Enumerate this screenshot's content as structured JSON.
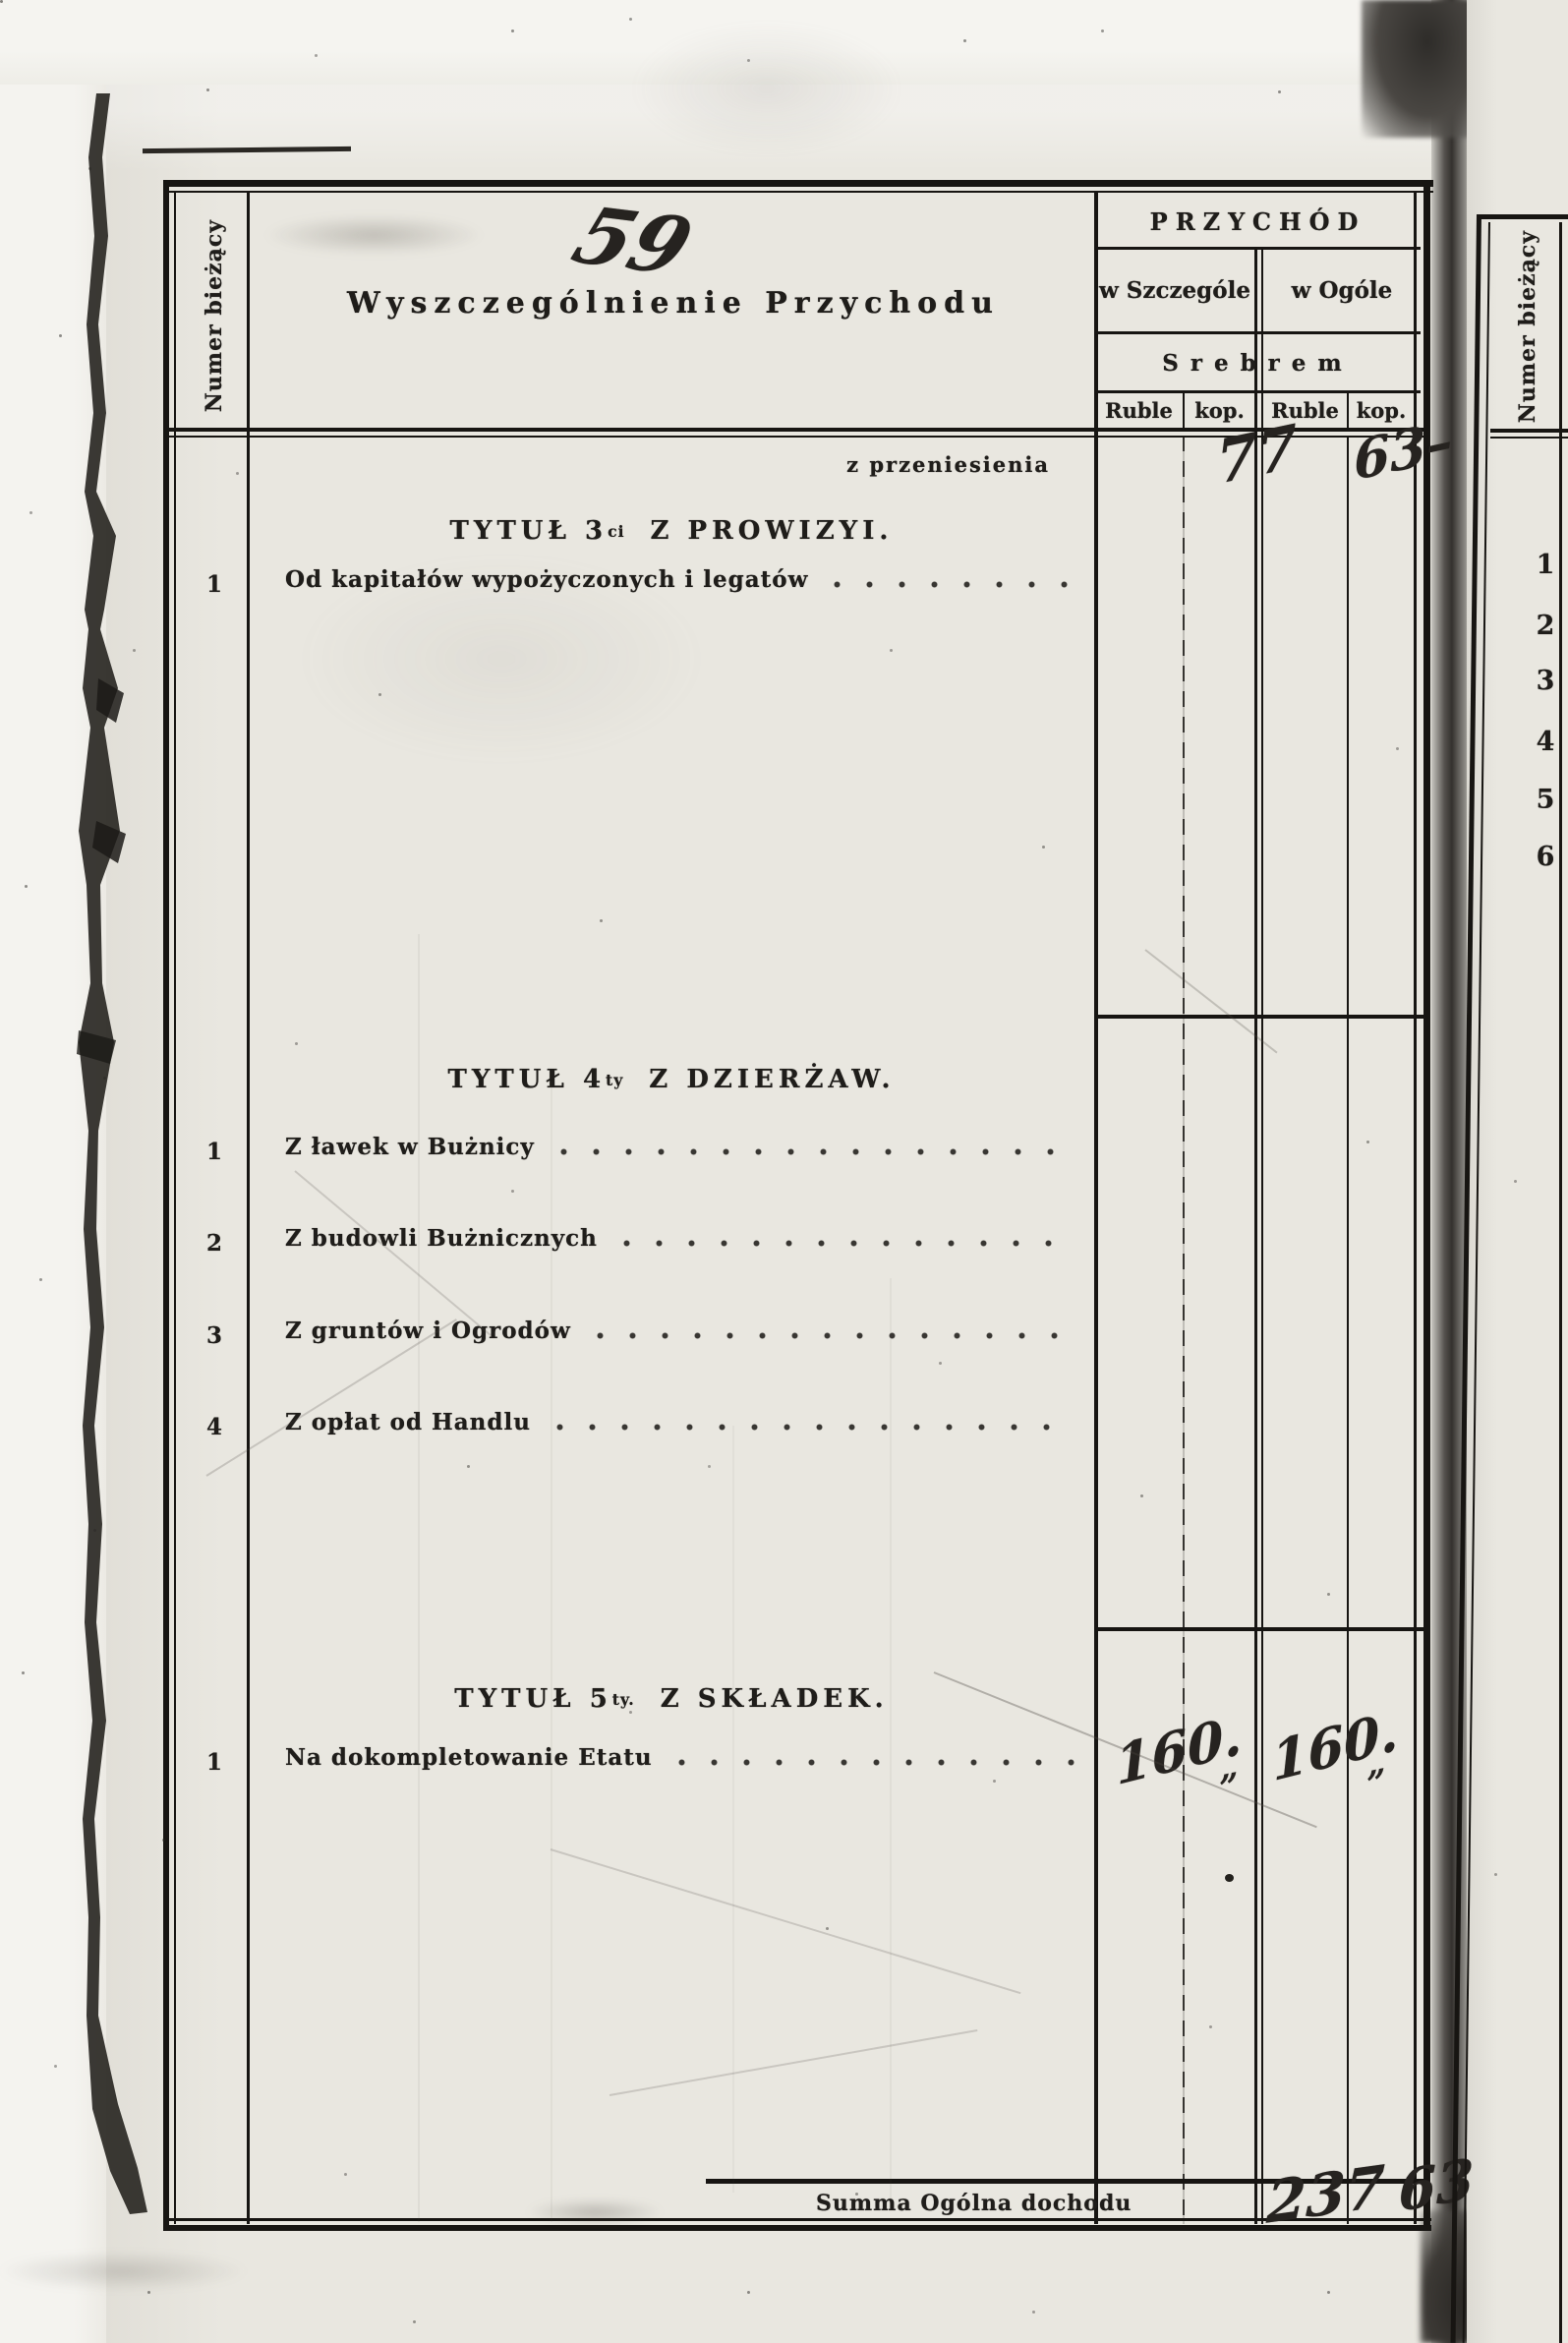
{
  "colors": {
    "paper": "#e9e7e0",
    "ink": "#1f1d1a",
    "gutter_shadow": "#34312e"
  },
  "page_marks": {
    "handwritten_page_number": "59"
  },
  "left_column": {
    "label": "Numer bieżący"
  },
  "header": {
    "description_title": "Wyszczególnienie  Przychodu",
    "income_title": "PRZYCHÓD",
    "col_detail": "w Szczególe",
    "col_total": "w Ogóle",
    "currency_row": "Srebrem",
    "subcols": {
      "c1": "Ruble",
      "c2": "kop.",
      "c3": "Ruble",
      "c4": "kop."
    }
  },
  "carryover": {
    "label": "z przeniesienia",
    "ogole_ruble": "77",
    "ogole_kop": "63–"
  },
  "sections": [
    {
      "title_prefix": "TYTUŁ 3",
      "title_sup": "ci",
      "title_rest": "Z PROWIZYI.",
      "rows": [
        {
          "num": "1",
          "label": "Od kapitałów wypożyczonych i legatów"
        }
      ]
    },
    {
      "title_prefix": "TYTUŁ 4",
      "title_sup": "ty",
      "title_rest": "Z DZIERŻAW.",
      "rows": [
        {
          "num": "1",
          "label": "Z ławek w Bużnicy"
        },
        {
          "num": "2",
          "label": "Z budowli Bużnicznych"
        },
        {
          "num": "3",
          "label": "Z gruntów i Ogrodów"
        },
        {
          "num": "4",
          "label": "Z opłat od Handlu"
        }
      ]
    },
    {
      "title_prefix": "TYTUŁ 5",
      "title_sup": "ty.",
      "title_rest": "Z SKŁADEK.",
      "rows": [
        {
          "num": "1",
          "label": "Na dokompletowanie Etatu"
        }
      ],
      "values": {
        "szczegole_ruble": "160.",
        "szczegole_kop": "„",
        "ogole_ruble": "160.",
        "ogole_kop": "„"
      }
    }
  ],
  "summary": {
    "label": "Summa Ogólna dochodu",
    "ogole_ruble": "237",
    "ogole_kop": "63"
  },
  "next_page": {
    "label": "Numer bieżący",
    "row_numbers": {
      "n1": "1",
      "n2": "2",
      "n3": "3",
      "n4": "4",
      "n5": "5",
      "n6": "6"
    }
  }
}
